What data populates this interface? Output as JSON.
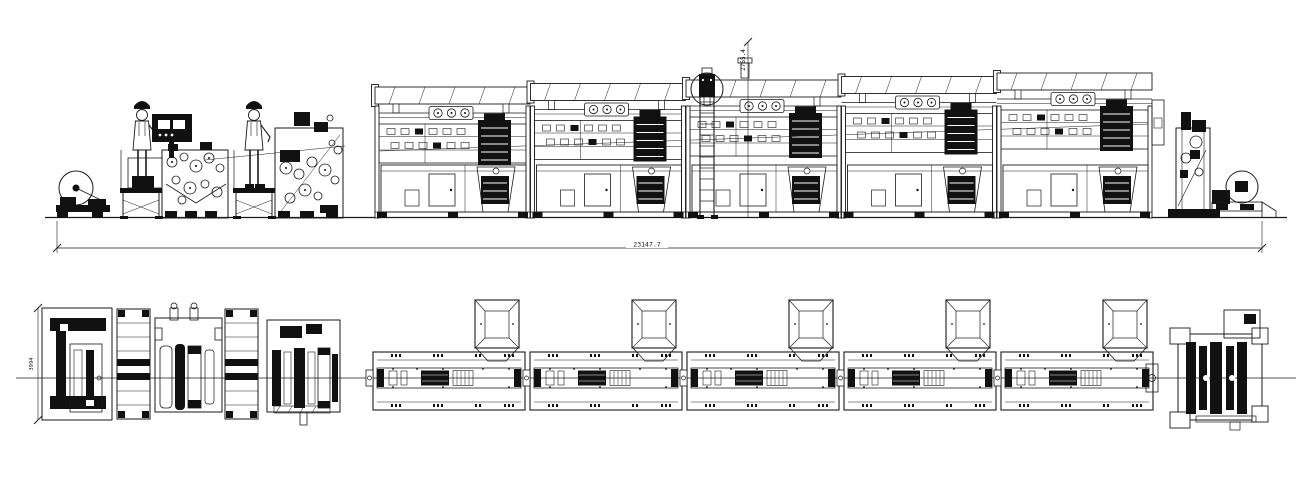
{
  "drawing": {
    "background": "#ffffff",
    "ink": "#1a1a1a",
    "dimensions": {
      "overall_length": "23147.7",
      "machine_height": "2765.4",
      "plan_width": "3994"
    }
  }
}
